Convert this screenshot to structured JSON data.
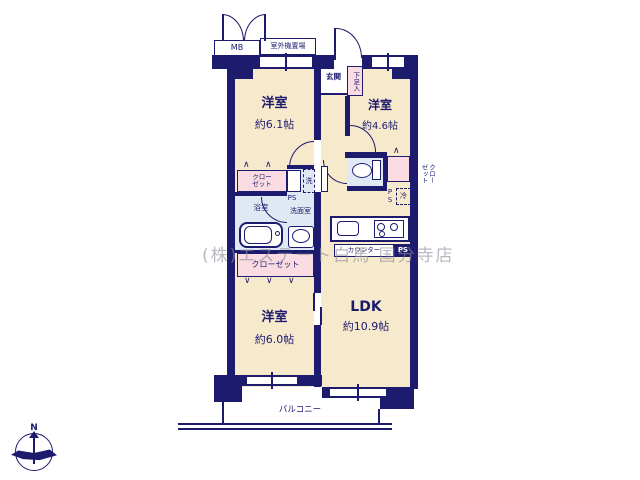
{
  "watermark": "(株)エステート白馬 国分寺店",
  "compass": {
    "north": "N"
  },
  "rooms": {
    "west61": {
      "name": "洋室",
      "size": "約6.1帖"
    },
    "west46": {
      "name": "洋室",
      "size": "約4.6帖"
    },
    "west60": {
      "name": "洋室",
      "size": "約6.0帖"
    },
    "ldk": {
      "name": "LDK",
      "size": "約10.9帖"
    },
    "entrance": "玄関",
    "bathroom": "浴室",
    "washroom": "洗面室",
    "balcony": "バルコニー"
  },
  "labels": {
    "mb": "MB",
    "outdoor_unit": "室外機置場",
    "shoe_cabinet": "下足入",
    "closet_two_line": "クロー\nゼット",
    "closet": "クローゼット",
    "closet_vertical": "クロー\nゼット",
    "washer": "洗",
    "fridge": "冷",
    "ps": "PS",
    "ps_vertical": "PS",
    "counter": "カウンター"
  },
  "colors": {
    "wall": "#1d1b6d",
    "room_floor": "#f7e9cc",
    "wet_floor": "#dfe9f4",
    "closet": "#fadce2",
    "watermark": "#8e8e9a"
  }
}
